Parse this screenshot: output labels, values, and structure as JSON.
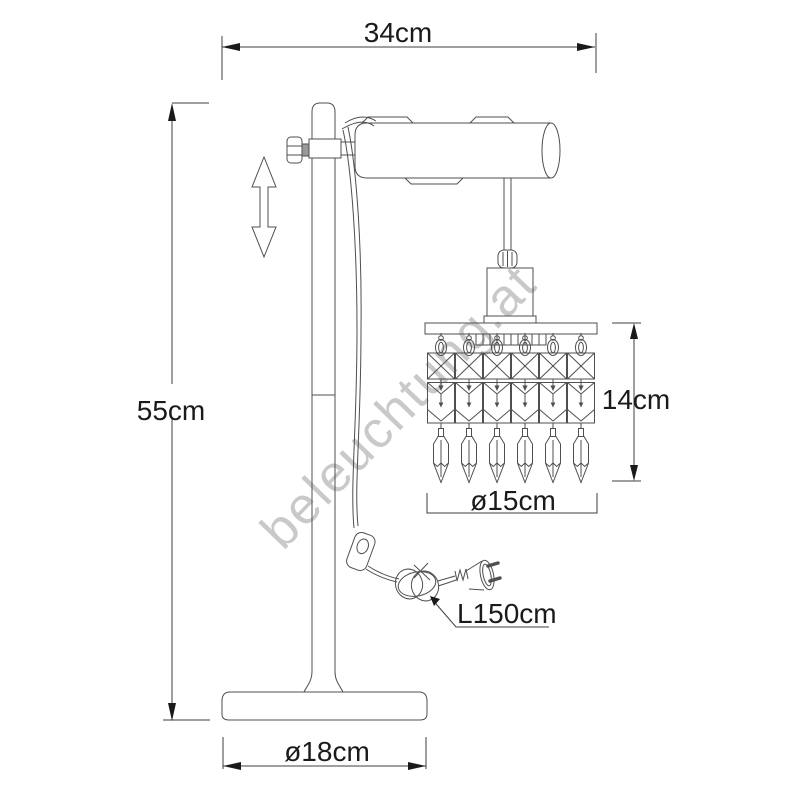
{
  "watermark": {
    "text": "beleuchtung.at",
    "color": "#c9c9c9"
  },
  "labels": {
    "total_width": "34cm",
    "total_height": "55cm",
    "pendant_height": "14cm",
    "pendant_diameter": "ø15cm",
    "cable_length": "L150cm",
    "base_diameter": "ø18cm"
  },
  "figure": {
    "kind": "technical dimension drawing",
    "subject": "table lamp with cylindrical head and crystal pendant strands",
    "pendant_strands": 6,
    "line_color": "#4f4f4f",
    "text_color": "#1a1a1a",
    "watermark_color": "#c9c9c9",
    "background_color": "#ffffff"
  }
}
